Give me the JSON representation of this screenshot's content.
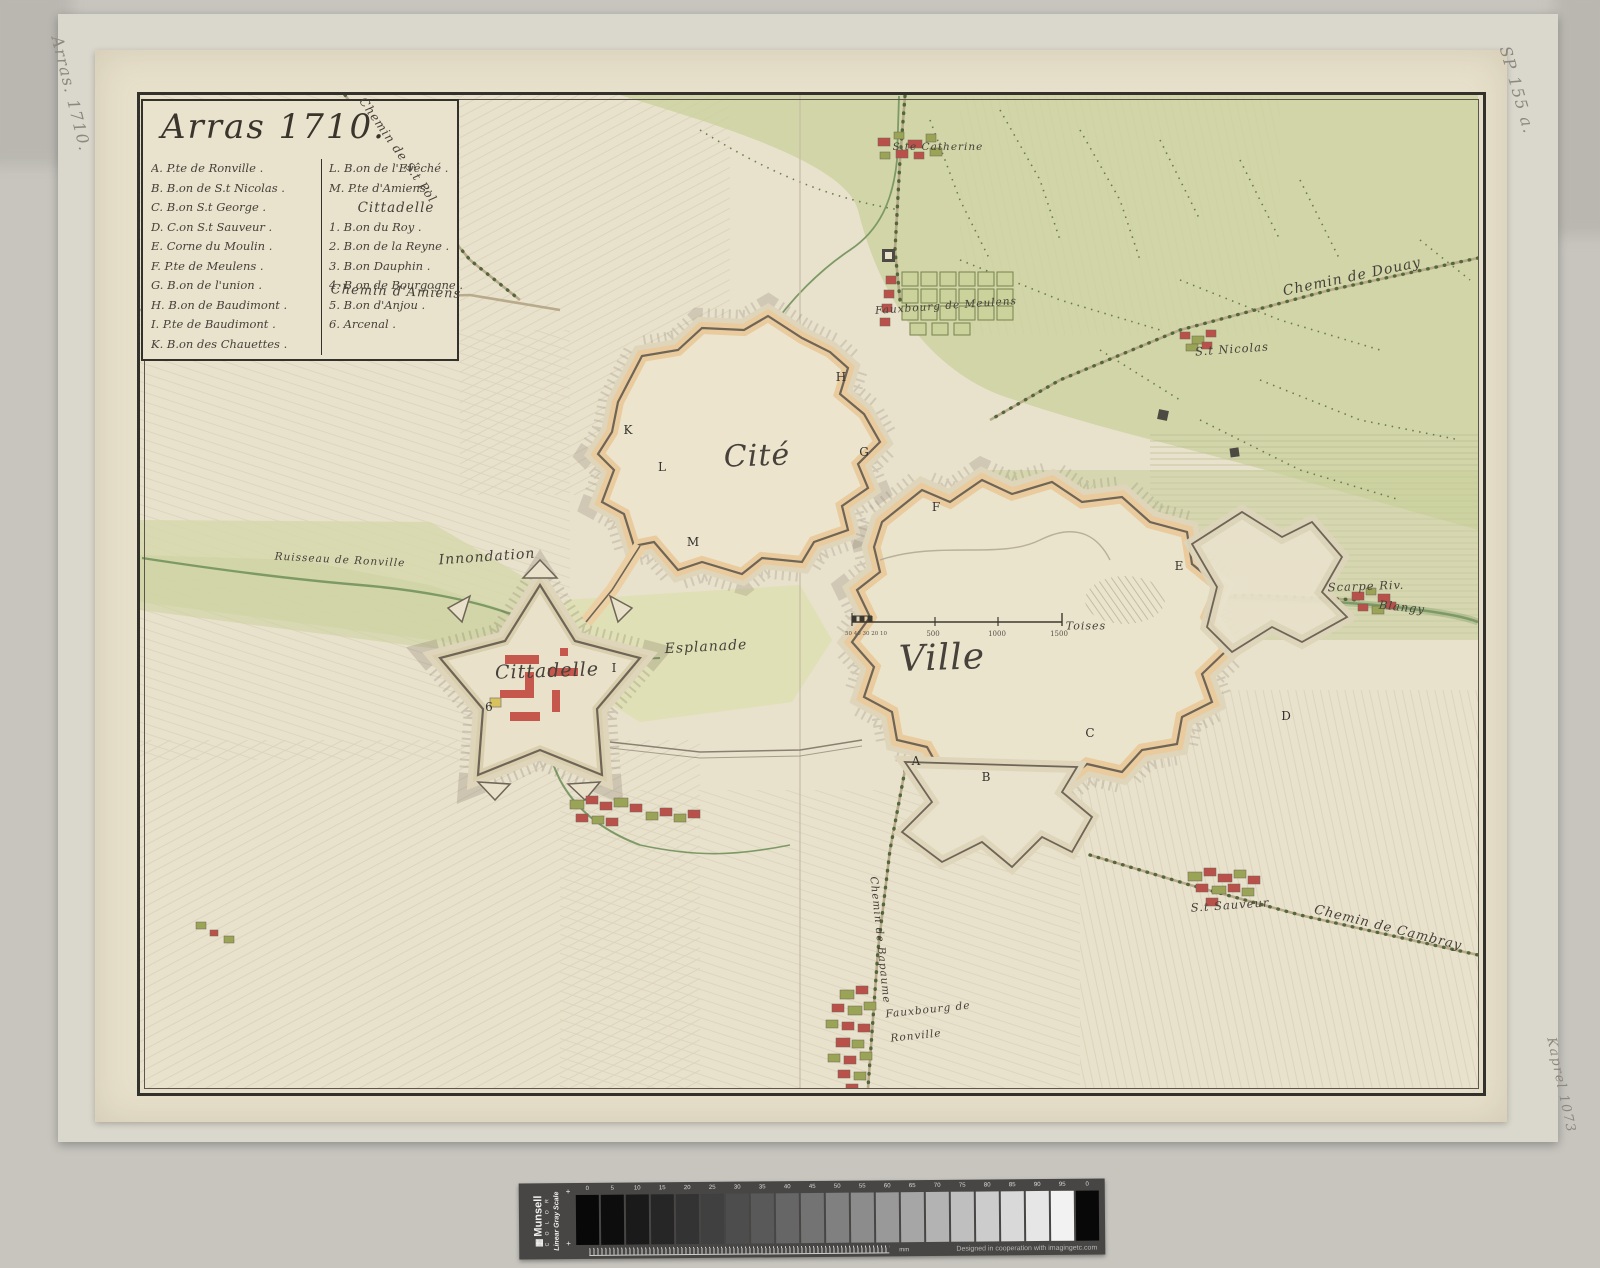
{
  "palette": {
    "scan_bg": "#c7c5be",
    "mount_paper": "#dad7cc",
    "map_paper": "#e7e0cb",
    "frame_ink": "#33312b",
    "field_green": "#ccd2a0",
    "water_green": "#7d9a66",
    "rampart_tan": "#e9cb9e",
    "building_red": "#bf544a",
    "ink": "#46413a"
  },
  "marginalia": {
    "top_left": "Arras. 1710.",
    "top_right": "SP 155 a.",
    "bottom_right": "Kaprel 1073"
  },
  "cartouche": {
    "title": "Arras 1710.",
    "col_left": [
      "A. P.te de Ronville .",
      "B. B.on de S.t Nicolas .",
      "C. B.on S.t George .",
      "D. C.on S.t Sauveur .",
      "E. Corne du Moulin .",
      "F. P.te de Meulens .",
      "G. B.on de l'union .",
      "H. B.on de Baudimont .",
      "I. P.te de Baudimont .",
      "K. B.on des Chauettes ."
    ],
    "col_right_top": [
      "L. B.on de l'Evêché .",
      "M. P.te d'Amiens ."
    ],
    "citadel_header": "Cittadelle",
    "col_right_list": [
      "1. B.on du Roy .",
      "2. B.on de la Reyne .",
      "3. B.on Dauphin .",
      "4. B.on de Bourgogne .",
      "5. B.on d'Anjou .",
      "6. Arcenal ."
    ]
  },
  "map": {
    "labels": [
      {
        "name": "cite",
        "text": "Cité",
        "x": 757,
        "y": 456,
        "size": 30,
        "rot": -2
      },
      {
        "name": "ville",
        "text": "Ville",
        "x": 942,
        "y": 658,
        "size": 36,
        "rot": -2
      },
      {
        "name": "cittadelle",
        "text": "Cittadelle",
        "x": 547,
        "y": 671,
        "size": 19,
        "rot": -2
      },
      {
        "name": "esplanade",
        "text": "Esplanade",
        "x": 706,
        "y": 647,
        "size": 14,
        "rot": -3
      },
      {
        "name": "innondation",
        "text": "Innondation",
        "x": 487,
        "y": 557,
        "size": 14,
        "rot": -4
      },
      {
        "name": "ruisseau-de-ronville",
        "text": "Ruisseau de Ronville",
        "x": 340,
        "y": 560,
        "size": 10.5,
        "rot": 3
      },
      {
        "name": "chemin-de-st-pol",
        "text": "Chemin de S.t Pol",
        "x": 398,
        "y": 150,
        "size": 12,
        "rot": 55
      },
      {
        "name": "chemin-d-amiens",
        "text": "Chemin d'Amiens",
        "x": 396,
        "y": 292,
        "size": 13,
        "rot": 2
      },
      {
        "name": "ste-catherine",
        "text": "S.te Catherine",
        "x": 938,
        "y": 147,
        "size": 10.5,
        "rot": 0
      },
      {
        "name": "fauxbourg-de-meulens",
        "text": "Fauxbourg de Meulens",
        "x": 946,
        "y": 306,
        "size": 10.5,
        "rot": -4
      },
      {
        "name": "st-nicolas",
        "text": "S.t Nicolas",
        "x": 1232,
        "y": 349,
        "size": 11.5,
        "rot": -4
      },
      {
        "name": "chemin-de-douay",
        "text": "Chemin de Douay",
        "x": 1352,
        "y": 277,
        "size": 14,
        "rot": -12
      },
      {
        "name": "scarpe-riv",
        "text": "Scarpe Riv.",
        "x": 1366,
        "y": 586,
        "size": 11.5,
        "rot": -2
      },
      {
        "name": "blangy",
        "text": "Blangy",
        "x": 1402,
        "y": 607,
        "size": 11.5,
        "rot": 6
      },
      {
        "name": "chemin-de-cambray",
        "text": "Chemin de Cambray",
        "x": 1388,
        "y": 928,
        "size": 13,
        "rot": 14
      },
      {
        "name": "st-sauveur",
        "text": "S.t Sauveur",
        "x": 1230,
        "y": 905,
        "size": 11.5,
        "rot": -4
      },
      {
        "name": "fauxbourg-de-ronville-line1",
        "text": "Fauxbourg de",
        "x": 928,
        "y": 1010,
        "size": 10.5,
        "rot": -6
      },
      {
        "name": "fauxbourg-de-ronville-line2",
        "text": "Ronville",
        "x": 916,
        "y": 1036,
        "size": 10.5,
        "rot": -6
      },
      {
        "name": "chemin-de-bapaume",
        "text": "Chemin de Bapaume",
        "x": 880,
        "y": 940,
        "size": 10.5,
        "rot": 84
      },
      {
        "name": "scale-minor",
        "text": "50 40 30 20 10",
        "x": 866,
        "y": 634,
        "size": 5.5,
        "rot": 0,
        "cls": "plain"
      },
      {
        "name": "scale-500",
        "text": "500",
        "x": 933,
        "y": 634,
        "size": 7,
        "rot": 0,
        "cls": "plain"
      },
      {
        "name": "scale-1000",
        "text": "1000",
        "x": 997,
        "y": 634,
        "size": 7,
        "rot": 0,
        "cls": "plain"
      },
      {
        "name": "scale-1500",
        "text": "1500",
        "x": 1059,
        "y": 634,
        "size": 7,
        "rot": 0,
        "cls": "plain"
      },
      {
        "name": "scale-toises",
        "text": "Toises",
        "x": 1086,
        "y": 626,
        "size": 11,
        "rot": 0
      }
    ],
    "letters": [
      {
        "t": "A",
        "x": 916,
        "y": 761
      },
      {
        "t": "B",
        "x": 986,
        "y": 777
      },
      {
        "t": "C",
        "x": 1090,
        "y": 733
      },
      {
        "t": "D",
        "x": 1286,
        "y": 716
      },
      {
        "t": "E",
        "x": 1179,
        "y": 566
      },
      {
        "t": "F",
        "x": 936,
        "y": 507
      },
      {
        "t": "G",
        "x": 864,
        "y": 452
      },
      {
        "t": "H",
        "x": 841,
        "y": 377
      },
      {
        "t": "I",
        "x": 614,
        "y": 668
      },
      {
        "t": "K",
        "x": 628,
        "y": 430
      },
      {
        "t": "L",
        "x": 662,
        "y": 467
      },
      {
        "t": "M",
        "x": 693,
        "y": 542
      },
      {
        "t": "6",
        "x": 489,
        "y": 707
      }
    ]
  },
  "munsell": {
    "brand": "Munsell",
    "brand_sub": "C O L O R",
    "scale_name": "Linear Gray Scale",
    "plus": "+",
    "values": [
      0,
      5,
      10,
      15,
      20,
      25,
      30,
      35,
      40,
      45,
      50,
      55,
      60,
      65,
      70,
      75,
      80,
      85,
      90,
      95
    ],
    "end_value": 0,
    "mm_label": "mm",
    "credit": "Designed in cooperation with imagingetc.com"
  }
}
